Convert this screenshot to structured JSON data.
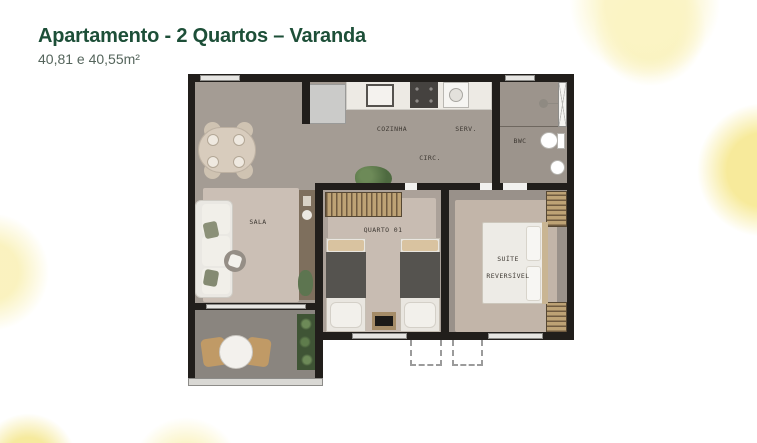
{
  "header": {
    "title": "Apartamento - 2 Quartos – Varanda",
    "subtitle": "40,81 e 40,55m²"
  },
  "floorplan": {
    "rooms": {
      "cozinha": {
        "label": "COZINHA"
      },
      "servico": {
        "label": "SERV."
      },
      "circulacao": {
        "label": "CIRC."
      },
      "bwc": {
        "label": "BWC"
      },
      "sala": {
        "label": "SALA"
      },
      "quarto01": {
        "label": "QUARTO 01"
      },
      "suite": {
        "label_line1": "SUÍTE",
        "label_line2": "REVERSÍVEL"
      }
    }
  },
  "colors": {
    "title_green": "#1d4f38",
    "subtitle_gray": "#55655c",
    "wall_black": "#211e1b",
    "floor_gray": "#a49c94",
    "rug_beige": "#c9bdb3",
    "wood_tan": "#c0a67c",
    "accent_yellow_strong": "#f6e891",
    "accent_yellow_soft": "#fbf3c6"
  }
}
